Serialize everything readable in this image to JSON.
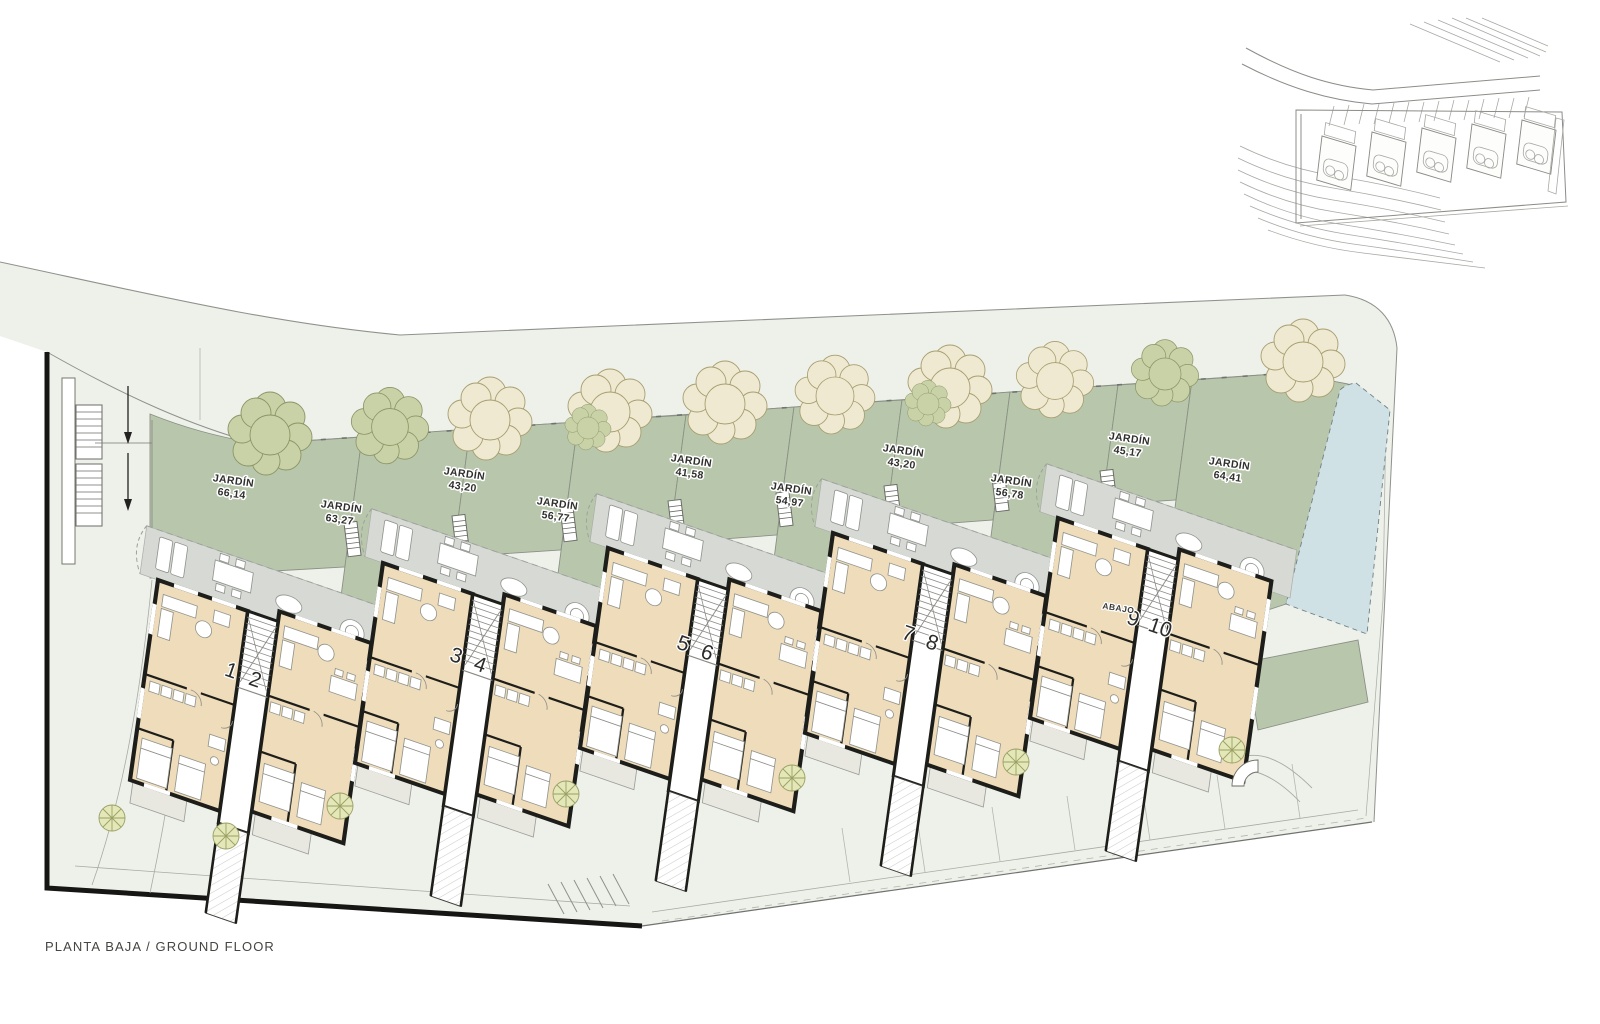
{
  "plan": {
    "footer_label": "PLANTA BAJA / GROUND FLOOR",
    "abajo_label": "ABAJO",
    "gardens": [
      {
        "label": "JARDÍN",
        "area": "66,14"
      },
      {
        "label": "JARDÍN",
        "area": "63,27"
      },
      {
        "label": "JARDÍN",
        "area": "43,20"
      },
      {
        "label": "JARDÍN",
        "area": "56,77"
      },
      {
        "label": "JARDÍN",
        "area": "41,58"
      },
      {
        "label": "JARDÍN",
        "area": "54,97"
      },
      {
        "label": "JARDÍN",
        "area": "43,20"
      },
      {
        "label": "JARDÍN",
        "area": "56,78"
      },
      {
        "label": "JARDÍN",
        "area": "45,17"
      },
      {
        "label": "JARDÍN",
        "area": "64,41"
      }
    ],
    "units": [
      {
        "number": "1"
      },
      {
        "number": "2"
      },
      {
        "number": "3"
      },
      {
        "number": "4"
      },
      {
        "number": "5"
      },
      {
        "number": "6"
      },
      {
        "number": "7"
      },
      {
        "number": "8"
      },
      {
        "number": "9"
      },
      {
        "number": "10"
      }
    ],
    "colors": {
      "ground": "#eef0ea",
      "garden": "#b8c7ac",
      "terrace": "#d7dad4",
      "building": "#eedcba",
      "wall": "#1d1d1a",
      "pool": "#cfe1e5",
      "tree_cream": "#efe9d2",
      "tree_green": "#c9d2a7",
      "tree_small": "#e4e8b8",
      "line": "#8f928c"
    }
  }
}
